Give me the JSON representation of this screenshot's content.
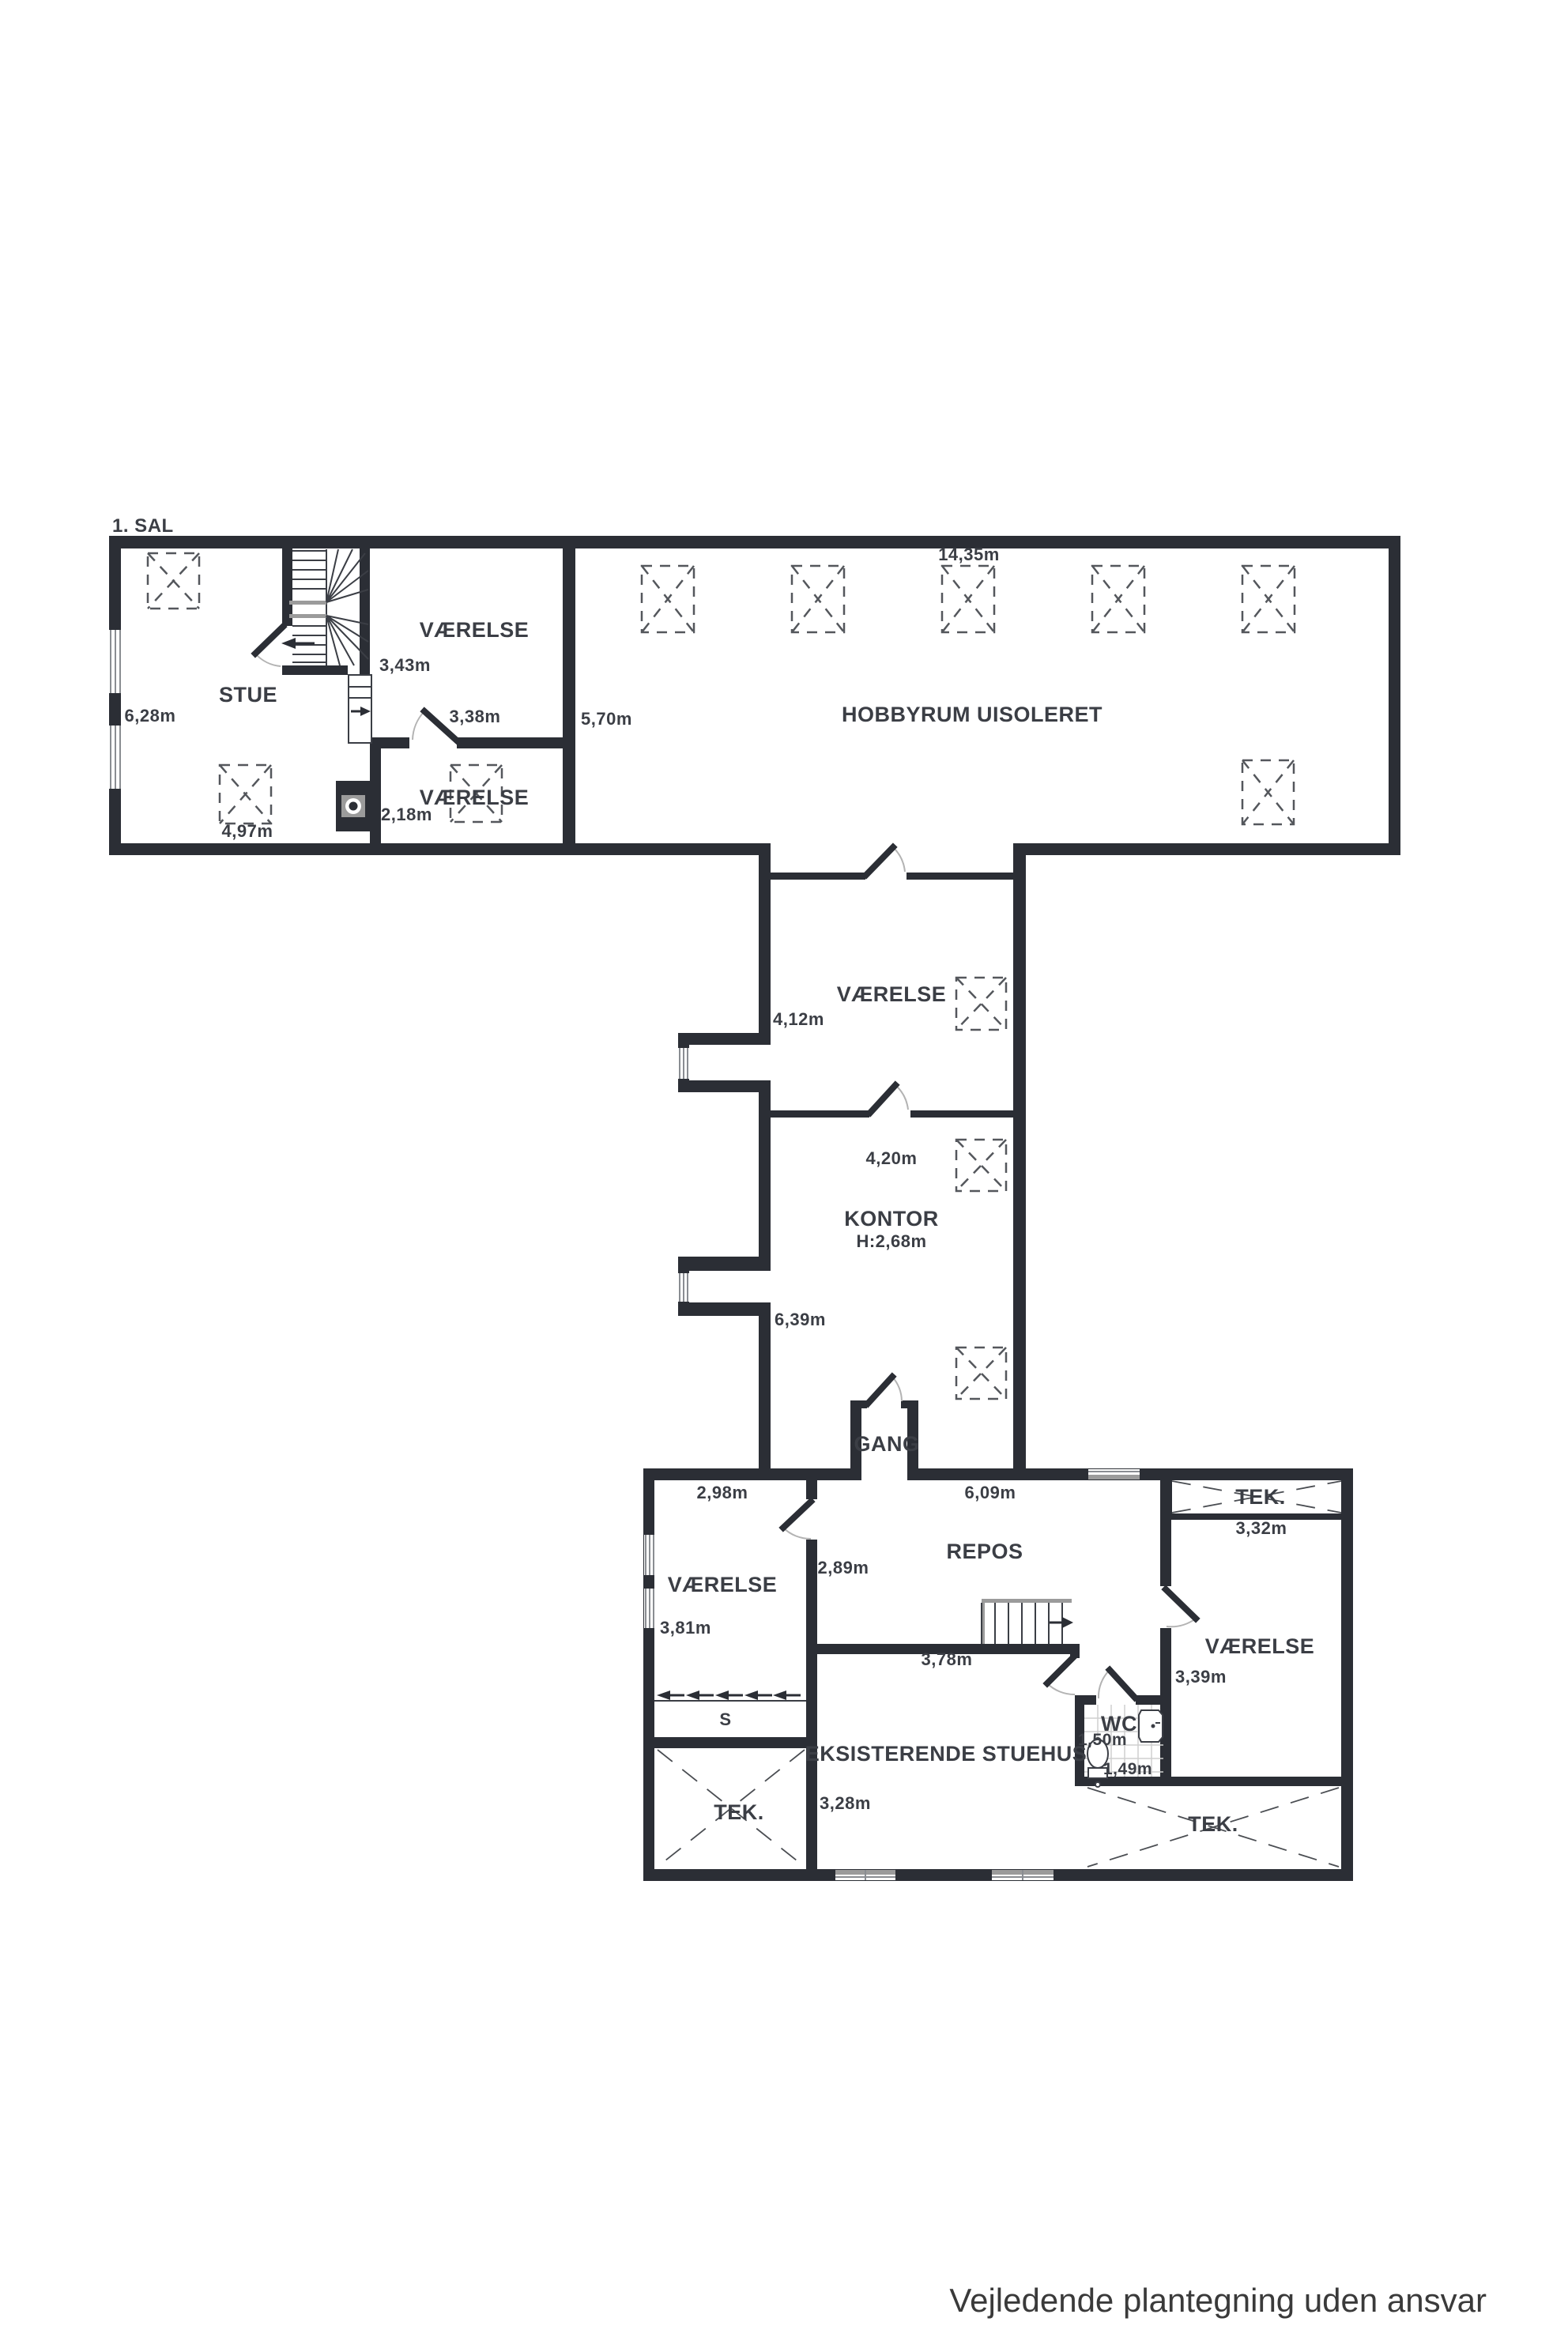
{
  "page": {
    "title": "1. SAL",
    "footer": "Vejledende plantegning uden ansvar"
  },
  "colors": {
    "wall": "#2b2e35",
    "text": "#3b3e45",
    "footer_text": "#3a3a3a",
    "door_arc": "#b3b3b3",
    "handrail_gray": "#9b9b9b",
    "roof_window_dash": "#54575c",
    "background": "#ffffff"
  },
  "rooms": {
    "stue": "STUE",
    "vaerelse_top": "VÆRELSE",
    "vaerelse_mellem": "VÆRELSE",
    "hobbyrum": "HOBBYRUM UISOLERET",
    "vaerelse_mid": "VÆRELSE",
    "kontor": "KONTOR",
    "kontor_height": "H:2,68m",
    "gang": "GANG",
    "repos": "REPOS",
    "tek_top": "TEK.",
    "vaerelse_left": "VÆRELSE",
    "vaerelse_right": "VÆRELSE",
    "wc": "WC",
    "s_closet": "S",
    "stuehus": "EKSISTERENDE STUEHUS",
    "tek_left": "TEK.",
    "tek_right": "TEK."
  },
  "dims": {
    "d343": "3,43m",
    "d628": "6,28m",
    "d338": "3,38m",
    "d570": "5,70m",
    "d218": "2,18m",
    "d497": "4,97m",
    "d1435": "14,35m",
    "d412": "4,12m",
    "d420": "4,20m",
    "d639": "6,39m",
    "d298": "2,98m",
    "d609": "6,09m",
    "d332": "3,32m",
    "d289": "2,89m",
    "d381": "3,81m",
    "d378": "3,78m",
    "d339": "3,39m",
    "d150": "1,50m",
    "d149": "1,49m",
    "d328": "3,28m"
  }
}
